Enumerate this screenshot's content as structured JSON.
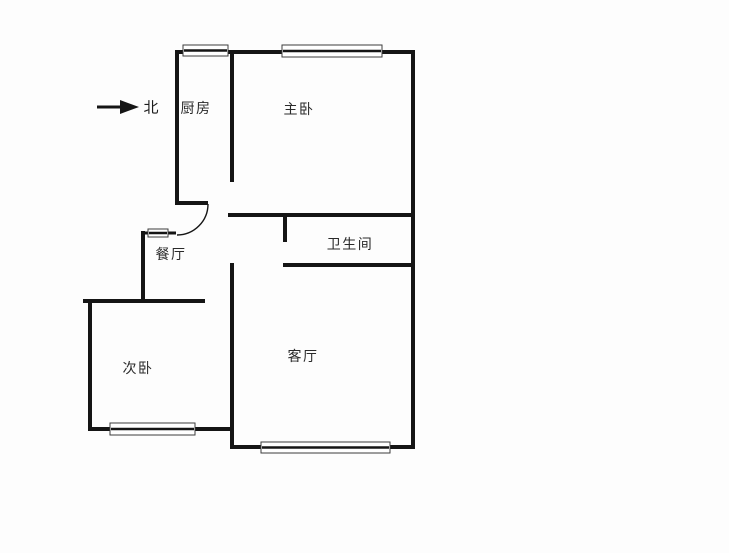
{
  "floorplan": {
    "background": "#fdfdfd",
    "wall_color": "#151515",
    "window_stroke": "#3c3c3c",
    "window_fill": "#ffffff",
    "text_color": "#2a2a2a",
    "compass": {
      "label": "北",
      "label_cx": 151,
      "label_cy": 107,
      "arrow": {
        "x1": 97,
        "y1": 107,
        "x2": 123,
        "y2": 107,
        "head": [
          [
            120,
            100
          ],
          [
            139,
            107
          ],
          [
            120,
            114
          ]
        ]
      }
    },
    "rooms": [
      {
        "id": "kitchen",
        "label": "厨房",
        "cx": 196,
        "cy": 108
      },
      {
        "id": "master-bedroom",
        "label": "主卧",
        "cx": 299,
        "cy": 109
      },
      {
        "id": "bathroom",
        "label": "卫生间",
        "cx": 350,
        "cy": 244
      },
      {
        "id": "dining-room",
        "label": "餐厅",
        "cx": 171,
        "cy": 254
      },
      {
        "id": "second-bedroom",
        "label": "次卧",
        "cx": 138,
        "cy": 368
      },
      {
        "id": "living-room",
        "label": "客厅",
        "cx": 303,
        "cy": 356
      }
    ],
    "walls": [
      {
        "x1": 175,
        "y1": 52,
        "x2": 415,
        "y2": 52,
        "t": 4
      },
      {
        "x1": 413,
        "y1": 50,
        "x2": 413,
        "y2": 449,
        "t": 4
      },
      {
        "x1": 230,
        "y1": 447,
        "x2": 415,
        "y2": 447,
        "t": 4
      },
      {
        "x1": 88,
        "y1": 429,
        "x2": 234,
        "y2": 429,
        "t": 4
      },
      {
        "x1": 90,
        "y1": 299,
        "x2": 90,
        "y2": 431,
        "t": 4
      },
      {
        "x1": 83,
        "y1": 301,
        "x2": 205,
        "y2": 301,
        "t": 4
      },
      {
        "x1": 143,
        "y1": 231,
        "x2": 143,
        "y2": 303,
        "t": 4
      },
      {
        "x1": 141,
        "y1": 233,
        "x2": 150,
        "y2": 233,
        "t": 3
      },
      {
        "x1": 166,
        "y1": 233,
        "x2": 176,
        "y2": 233,
        "t": 3
      },
      {
        "x1": 177,
        "y1": 50,
        "x2": 177,
        "y2": 205,
        "t": 4
      },
      {
        "x1": 175,
        "y1": 203,
        "x2": 208,
        "y2": 203,
        "t": 4
      },
      {
        "x1": 232,
        "y1": 52,
        "x2": 232,
        "y2": 182,
        "t": 4
      },
      {
        "x1": 228,
        "y1": 215,
        "x2": 415,
        "y2": 215,
        "t": 4
      },
      {
        "x1": 285,
        "y1": 213,
        "x2": 285,
        "y2": 242,
        "t": 4
      },
      {
        "x1": 283,
        "y1": 265,
        "x2": 415,
        "y2": 265,
        "t": 4
      },
      {
        "x1": 232,
        "y1": 263,
        "x2": 232,
        "y2": 449,
        "t": 4
      }
    ],
    "windows": [
      {
        "x": 183,
        "y": 45,
        "w": 45,
        "h": 11
      },
      {
        "x": 282,
        "y": 45,
        "w": 100,
        "h": 12
      },
      {
        "x": 148,
        "y": 229,
        "w": 20,
        "h": 8
      },
      {
        "x": 110,
        "y": 423,
        "w": 85,
        "h": 12
      },
      {
        "x": 261,
        "y": 442,
        "w": 129,
        "h": 11
      }
    ],
    "door_arc": {
      "d": "M 208 204 A 31 31 0 0 1 177 235",
      "width": 1.4
    }
  }
}
